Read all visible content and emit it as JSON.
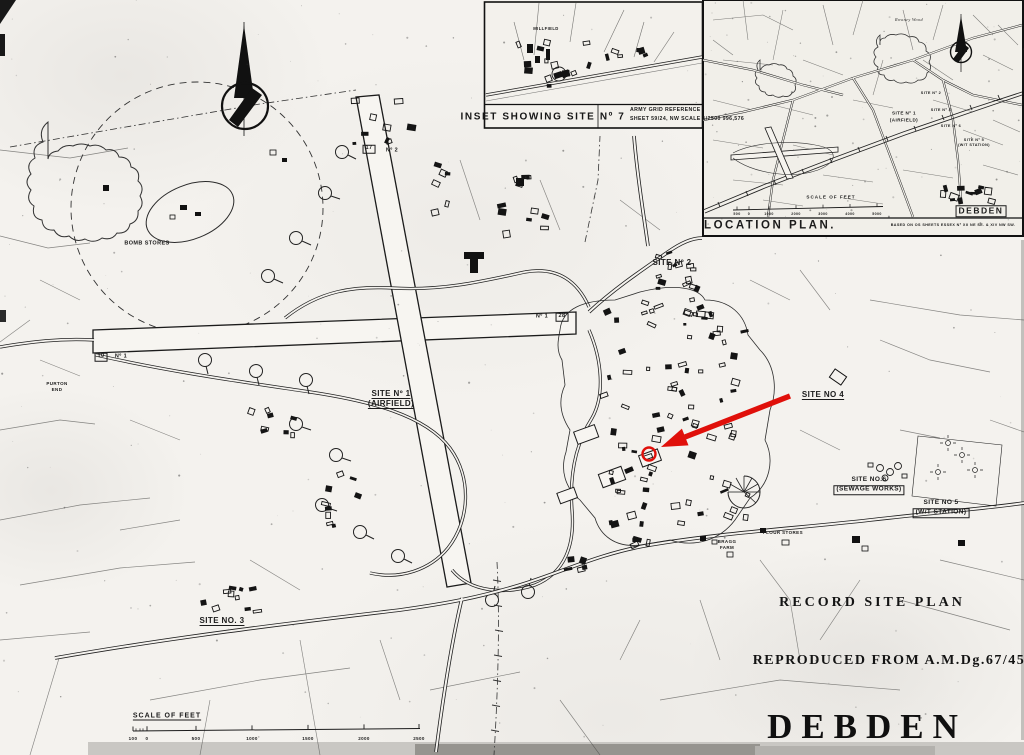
{
  "colors": {
    "paper": "#f4f2ee",
    "ink": "#1b1b1b",
    "annotation_red": "#e0100a"
  },
  "titles": {
    "record": "RECORD SITE PLAN",
    "reproduced": "REPRODUCED FROM A.M.Dg.67/45",
    "place": "DEBDEN"
  },
  "inset_site7": {
    "title": "INSET SHOWING SITE Nº 7",
    "grid_ref_line1": "ARMY GRID REFERENCE",
    "grid_ref_line2": "SHEET 59/24, NW SCALE 1/2500 996,576",
    "labels": [
      {
        "text": "MILLFIELD",
        "x": 546,
        "y": 29,
        "fs": 4.2
      }
    ]
  },
  "location_plan": {
    "labels": [
      {
        "text": "Rowney Wood",
        "x": 909,
        "y": 20,
        "fs": 4.2,
        "serif": true,
        "ital": true
      },
      {
        "text": "SITE Nº 2",
        "x": 931,
        "y": 94,
        "fs": 3.8
      },
      {
        "text": "SITE Nº 1",
        "x": 904,
        "y": 114,
        "fs": 4.6
      },
      {
        "text": "(AIRFIELD)",
        "x": 904,
        "y": 121,
        "fs": 4.6
      },
      {
        "text": "SITE Nº 4",
        "x": 941,
        "y": 111,
        "fs": 3.8
      },
      {
        "text": "SITE Nº 6",
        "x": 951,
        "y": 127,
        "fs": 3.8
      },
      {
        "text": "SITE Nº 5",
        "x": 974,
        "y": 141,
        "fs": 3.8
      },
      {
        "text": "(W/T STATION)",
        "x": 974,
        "y": 146,
        "fs": 3.8
      },
      {
        "text": "SCALE OF FEET",
        "x": 831,
        "y": 198,
        "fs": 4.6,
        "ls": 1
      },
      {
        "text": "500",
        "x": 737,
        "y": 215,
        "fs": 3.6
      },
      {
        "text": "0",
        "x": 749,
        "y": 215,
        "fs": 3.6
      },
      {
        "text": "1000",
        "x": 769,
        "y": 215,
        "fs": 3.6
      },
      {
        "text": "2000",
        "x": 796,
        "y": 215,
        "fs": 3.6
      },
      {
        "text": "3000",
        "x": 823,
        "y": 215,
        "fs": 3.6
      },
      {
        "text": "4000",
        "x": 850,
        "y": 215,
        "fs": 3.6
      },
      {
        "text": "5000",
        "x": 877,
        "y": 215,
        "fs": 3.6
      },
      {
        "text": "DEBDEN",
        "x": 981,
        "y": 211,
        "fs": 8.5,
        "box": true,
        "ls": 1.5
      },
      {
        "text": "LOCATION PLAN.",
        "x": 770,
        "y": 226,
        "fs": 11.5,
        "ls": 2.5
      },
      {
        "text": "BASED ON OS SHEETS ESSEX Nº XII NE SE. & XIV NW SW.",
        "x": 953,
        "y": 226,
        "fs": 3.7
      }
    ]
  },
  "main_map": {
    "labels": [
      {
        "text": "BOMB STORES",
        "x": 147,
        "y": 244,
        "fs": 5.5
      },
      {
        "text": "SITE Nº 1",
        "x": 391,
        "y": 394,
        "fs": 8,
        "u": true
      },
      {
        "text": "(AIRFIELD)",
        "x": 391,
        "y": 404,
        "fs": 8,
        "u": true
      },
      {
        "text": "SITE Nº 2",
        "x": 672,
        "y": 263,
        "fs": 8
      },
      {
        "text": "SITE NO 4",
        "x": 823,
        "y": 395,
        "fs": 8,
        "u": true
      },
      {
        "text": "SITE NO.6",
        "x": 869,
        "y": 480,
        "fs": 6.5
      },
      {
        "text": "(SEWAGE WORKS)",
        "x": 869,
        "y": 490,
        "fs": 6.5,
        "box": true
      },
      {
        "text": "SITE NO 5",
        "x": 941,
        "y": 503,
        "fs": 6.5
      },
      {
        "text": "(W/T STATION)",
        "x": 941,
        "y": 513,
        "fs": 6.5,
        "box": true
      },
      {
        "text": "SITE NO. 3",
        "x": 222,
        "y": 621,
        "fs": 8,
        "u": true
      },
      {
        "text": "BRAGG",
        "x": 727,
        "y": 542,
        "fs": 4.5
      },
      {
        "text": "FARM",
        "x": 727,
        "y": 548,
        "fs": 4.5
      },
      {
        "text": "FLOUR STORES",
        "x": 783,
        "y": 533,
        "fs": 4.5
      },
      {
        "text": "PURTON",
        "x": 57,
        "y": 384,
        "fs": 4.5
      },
      {
        "text": "END",
        "x": 57,
        "y": 390,
        "fs": 4.5
      },
      {
        "text": "10",
        "x": 101,
        "y": 357,
        "fs": 5.5,
        "box": true
      },
      {
        "text": "Nº 1",
        "x": 121,
        "y": 357,
        "fs": 5.5
      },
      {
        "text": "Nº 1",
        "x": 542,
        "y": 317,
        "fs": 5.5
      },
      {
        "text": "28",
        "x": 562,
        "y": 317,
        "fs": 5.5,
        "box": true
      },
      {
        "text": "17",
        "x": 369,
        "y": 149,
        "fs": 5.5,
        "box": true
      },
      {
        "text": "Nº 2",
        "x": 392,
        "y": 151,
        "fs": 5.5
      },
      {
        "text": "SCALE OF FEET",
        "x": 167,
        "y": 716,
        "fs": 7,
        "u": true,
        "ls": 1
      },
      {
        "text": "100",
        "x": 133,
        "y": 739,
        "fs": 4.5
      },
      {
        "text": "0",
        "x": 147,
        "y": 739,
        "fs": 4.5
      },
      {
        "text": "500",
        "x": 196,
        "y": 739,
        "fs": 4.5
      },
      {
        "text": "1000",
        "x": 252,
        "y": 739,
        "fs": 4.5
      },
      {
        "text": "1500",
        "x": 308,
        "y": 739,
        "fs": 4.5
      },
      {
        "text": "2000",
        "x": 364,
        "y": 739,
        "fs": 4.5
      },
      {
        "text": "2500",
        "x": 419,
        "y": 739,
        "fs": 4.5
      }
    ]
  }
}
